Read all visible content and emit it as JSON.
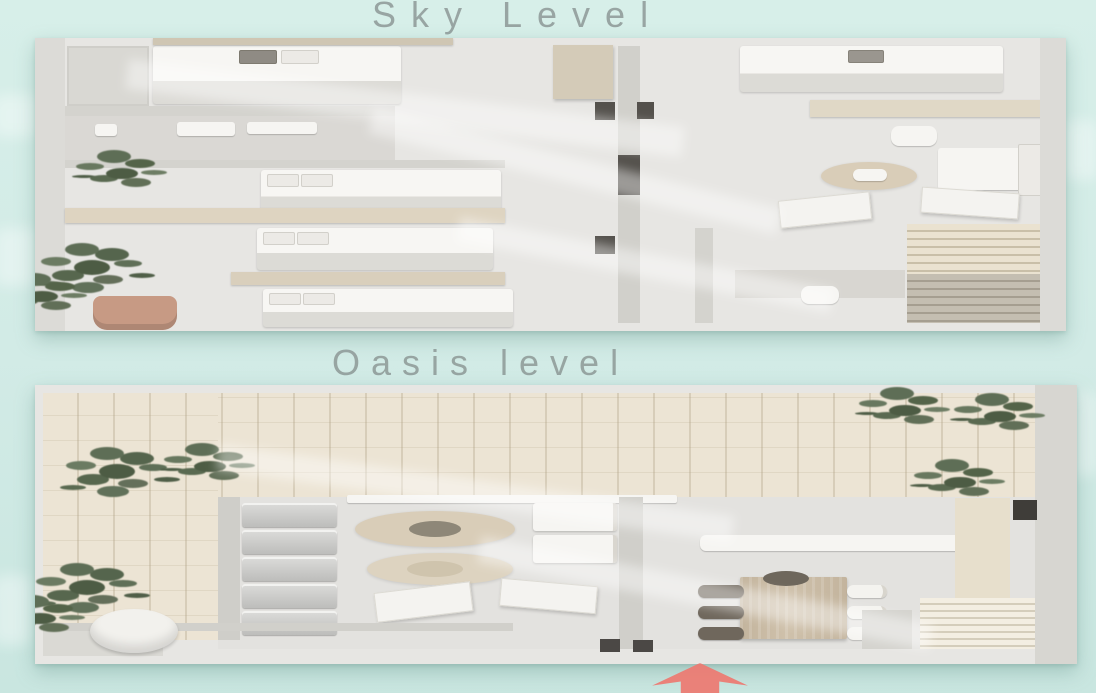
{
  "plans": {
    "sky": {
      "title": "Sky Level",
      "elements": [
        "bed",
        "wardrobe",
        "bathroom-fixtures",
        "wood-shelf",
        "plant",
        "terracotta-pot",
        "sofa",
        "armchair",
        "round-rug",
        "floor-mat",
        "louver-deck",
        "desk",
        "desk-chair"
      ]
    },
    "oasis": {
      "title": "Oasis level",
      "elements": [
        "wood-deck",
        "plant",
        "white-planter-pot",
        "kitchen-appliance-stack",
        "counter-rail",
        "drawer-unit",
        "round-rug",
        "floor-mat",
        "bench",
        "dining-table",
        "dining-chairs",
        "louver-deck",
        "entrance-door"
      ]
    }
  },
  "annotations": {
    "entrance_arrow": {
      "icon": "arrow-up",
      "color": "#ed7a72"
    }
  },
  "palette": {
    "background": "#d3ece7",
    "wall": "#d5d4cf",
    "floor": "#e7e6e3",
    "deck_wood": "#ece4d4",
    "table_wood": "#c8baa4",
    "shelf_wood": "#ded4c1",
    "plant_green": "#5e6e56",
    "terracotta": "#c79a84",
    "white_furniture": "#f6f5f2",
    "title_text": "#8b9694",
    "arrow": "#ed7a72"
  }
}
